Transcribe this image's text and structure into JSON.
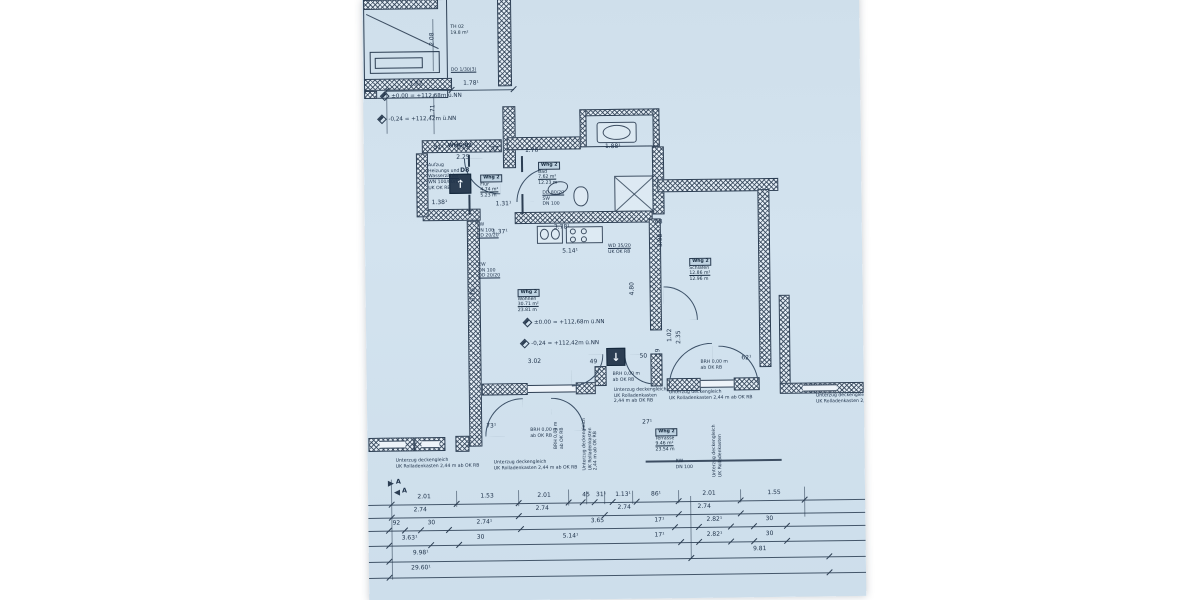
{
  "meta": {
    "sheet_bg": "#cfdfeb",
    "ink": "#2c3e53"
  },
  "labels": {
    "whg": "WHG 02",
    "door": "D8",
    "section": "A"
  },
  "icons": {
    "arrow_up": "↑",
    "arrow_down": "↓"
  },
  "apartment": "Whg 2",
  "stamps": [
    {
      "x": 116,
      "y": 176,
      "head": "Whg 2",
      "lines": [
        "Flur",
        "4.74 m²",
        "5.23 m"
      ],
      "u": 1
    },
    {
      "x": 174,
      "y": 164,
      "head": "Whg 2",
      "lines": [
        "Bad",
        "7.62 m²",
        "12.23 m"
      ],
      "u": 1
    },
    {
      "x": 152,
      "y": 291,
      "head": "Whg 2",
      "lines": [
        "Wohnen",
        "30.71 m²",
        "23.81 m"
      ],
      "u": 1
    },
    {
      "x": 324,
      "y": 262,
      "head": "Whg 2",
      "lines": [
        "Schlafen",
        "12.86 m²",
        "12.96 m"
      ],
      "u": 1
    },
    {
      "x": 288,
      "y": 432,
      "head": "Whg 2",
      "lines": [
        "Terrasse",
        "9.46 m²",
        "23.54 m"
      ],
      "u": 1
    },
    {
      "x": 88,
      "y": 26,
      "head": "",
      "lines": [
        "TH 02",
        "19.8 m²"
      ],
      "u": -1
    }
  ],
  "notes": [
    {
      "x": 64,
      "y": 164,
      "lines": [
        "Aufzug",
        "Heizungs und",
        "Wasserzähler",
        "WN 100/80/11",
        "UK OK RB"
      ],
      "u": 2
    },
    {
      "x": 112,
      "y": 224,
      "lines": [
        "SW",
        "DN 100",
        "DD 20/20"
      ],
      "u": 2
    },
    {
      "x": 113,
      "y": 264,
      "lines": [
        "EW",
        "DN 100",
        "DD 20/20"
      ],
      "u": 2
    },
    {
      "x": 178,
      "y": 193,
      "lines": [
        "DD 80/20",
        "SW",
        "DN 100"
      ],
      "u": 0
    },
    {
      "x": 243,
      "y": 247,
      "lines": [
        "WD 35/20",
        "UK OK RB"
      ],
      "u": 0
    },
    {
      "x": 246,
      "y": 375,
      "lines": [
        "BRH 0,00 m",
        "ab OK RB"
      ],
      "u": -1
    },
    {
      "x": 334,
      "y": 364,
      "lines": [
        "BRH 0,00 m",
        "ab OK RB"
      ],
      "u": -1
    },
    {
      "x": 163,
      "y": 430,
      "lines": [
        "BRH 0,00 m",
        "ab OK RB"
      ],
      "u": -1
    },
    {
      "x": 28,
      "y": 459,
      "lines": [
        "Unterzug deckengleich",
        "UK Rolladenkasten 2,44 m ab OK RB"
      ],
      "u": -1
    },
    {
      "x": 126,
      "y": 462,
      "lines": [
        "Unterzug deckengleich",
        "UK Rolladenkasten 2,44 m ab OK RB"
      ],
      "u": -1
    },
    {
      "x": 247,
      "y": 391,
      "lines": [
        "Unterzug deckengleich",
        "UK Rolladenkasten",
        "2,44 m ab OK RB"
      ],
      "u": -1
    },
    {
      "x": 302,
      "y": 394,
      "lines": [
        "Unterzug deckengleich",
        "UK Rolladenkasten 2,44 m ab OK RB"
      ],
      "u": -1
    },
    {
      "x": 449,
      "y": 399,
      "lines": [
        "Unterzug deckengleich",
        "UK Rolladenkasten 2,44"
      ],
      "u": -1
    },
    {
      "x": 232,
      "y": 456,
      "rot": true,
      "lines": [
        "Unterzug deckengleich",
        "UK Rolladenkasten",
        "2,44 m ab OK RB"
      ],
      "u": -1
    },
    {
      "x": 198,
      "y": 440,
      "rot": true,
      "lines": [
        "BRH 0,00 m",
        "ab OK RB"
      ],
      "u": -1
    },
    {
      "x": 356,
      "y": 470,
      "rot": true,
      "lines": [
        "Unterzug deckengleich",
        "UK Rolladenkasten"
      ],
      "u": -1
    },
    {
      "x": 308,
      "y": 463,
      "lines": [
        "RW",
        "DN 100"
      ],
      "u": -1
    },
    {
      "x": 88,
      "y": 69,
      "lines": [
        "DO 1/30(3)"
      ],
      "u": 0
    }
  ],
  "level_marks": [
    {
      "x": 18,
      "y": 93,
      "text": "±0.00 = +112,68m ü.NN"
    },
    {
      "x": 15,
      "y": 116,
      "text": "-0,24 = +112,42m ü.NN"
    },
    {
      "x": 158,
      "y": 321,
      "text": "±0.00 = +112,68m ü.NN"
    },
    {
      "x": 155,
      "y": 342,
      "text": "-0,24 = +112,42m ü.NN"
    }
  ],
  "dims": [
    {
      "x": 53,
      "y": 85,
      "t": "1.82"
    },
    {
      "x": 108,
      "y": 85,
      "t": "1.78¹"
    },
    {
      "x": 70,
      "y": 40,
      "t": "2.08",
      "r": true
    },
    {
      "x": 70,
      "y": 112,
      "t": "1.71",
      "r": true
    },
    {
      "x": 75,
      "y": 149,
      "t": "51¹"
    },
    {
      "x": 99,
      "y": 149,
      "t": "1.15"
    },
    {
      "x": 131,
      "y": 151,
      "t": "87"
    },
    {
      "x": 99,
      "y": 159,
      "t": "2.25"
    },
    {
      "x": 169,
      "y": 153,
      "t": "1.76¹"
    },
    {
      "x": 249,
      "y": 150,
      "t": "1.88¹"
    },
    {
      "x": 75,
      "y": 204,
      "t": "1.38¹"
    },
    {
      "x": 139,
      "y": 206,
      "t": "1.31¹"
    },
    {
      "x": 135,
      "y": 234,
      "t": "1.37¹"
    },
    {
      "x": 197,
      "y": 230,
      "t": "3.78¹"
    },
    {
      "x": 205,
      "y": 254,
      "t": "5.14¹"
    },
    {
      "x": 294,
      "y": 226,
      "t": "68"
    },
    {
      "x": 168,
      "y": 364,
      "t": "3.02"
    },
    {
      "x": 227,
      "y": 365,
      "t": "49"
    },
    {
      "x": 277,
      "y": 360,
      "t": "50"
    },
    {
      "x": 292,
      "y": 356,
      "t": "19",
      "r": true
    },
    {
      "x": 380,
      "y": 363,
      "t": "62¹"
    },
    {
      "x": 124,
      "y": 428,
      "t": "73¹"
    },
    {
      "x": 280,
      "y": 426,
      "t": "27¹"
    },
    {
      "x": 108,
      "y": 296,
      "t": "6.76",
      "r": true
    },
    {
      "x": 267,
      "y": 292,
      "t": "4.80",
      "r": true
    },
    {
      "x": 296,
      "y": 244,
      "t": "3.98",
      "r": true
    },
    {
      "x": 304,
      "y": 339,
      "t": "1.02",
      "r": true
    },
    {
      "x": 313,
      "y": 341,
      "t": "2.35",
      "r": true
    },
    {
      "x": 56,
      "y": 498,
      "t": "2.01"
    },
    {
      "x": 119,
      "y": 498,
      "t": "1.53"
    },
    {
      "x": 176,
      "y": 498,
      "t": "2.01"
    },
    {
      "x": 218,
      "y": 498,
      "t": "45"
    },
    {
      "x": 233,
      "y": 498,
      "t": "31¹"
    },
    {
      "x": 255,
      "y": 498,
      "t": "1.13¹"
    },
    {
      "x": 288,
      "y": 498,
      "t": "86¹"
    },
    {
      "x": 341,
      "y": 498,
      "t": "2.01"
    },
    {
      "x": 406,
      "y": 498,
      "t": "1.55"
    },
    {
      "x": 52,
      "y": 511,
      "t": "2.74"
    },
    {
      "x": 174,
      "y": 511,
      "t": "2.74"
    },
    {
      "x": 256,
      "y": 511,
      "t": "2.74"
    },
    {
      "x": 336,
      "y": 511,
      "t": "2.74"
    },
    {
      "x": 28,
      "y": 524,
      "t": "92"
    },
    {
      "x": 63,
      "y": 524,
      "t": "30"
    },
    {
      "x": 116,
      "y": 524,
      "t": "2.74¹"
    },
    {
      "x": 229,
      "y": 524,
      "t": "3.65"
    },
    {
      "x": 291,
      "y": 524,
      "t": "17¹"
    },
    {
      "x": 346,
      "y": 524,
      "t": "2.82¹"
    },
    {
      "x": 401,
      "y": 524,
      "t": "30"
    },
    {
      "x": 41,
      "y": 539,
      "t": "3.63¹"
    },
    {
      "x": 112,
      "y": 539,
      "t": "30"
    },
    {
      "x": 202,
      "y": 539,
      "t": "5.14¹"
    },
    {
      "x": 291,
      "y": 539,
      "t": "17¹"
    },
    {
      "x": 346,
      "y": 539,
      "t": "2.82¹"
    },
    {
      "x": 401,
      "y": 539,
      "t": "30"
    },
    {
      "x": 52,
      "y": 554,
      "t": "9.98¹"
    },
    {
      "x": 391,
      "y": 554,
      "t": "9.81"
    },
    {
      "x": 52,
      "y": 569,
      "t": "29.60¹"
    }
  ]
}
